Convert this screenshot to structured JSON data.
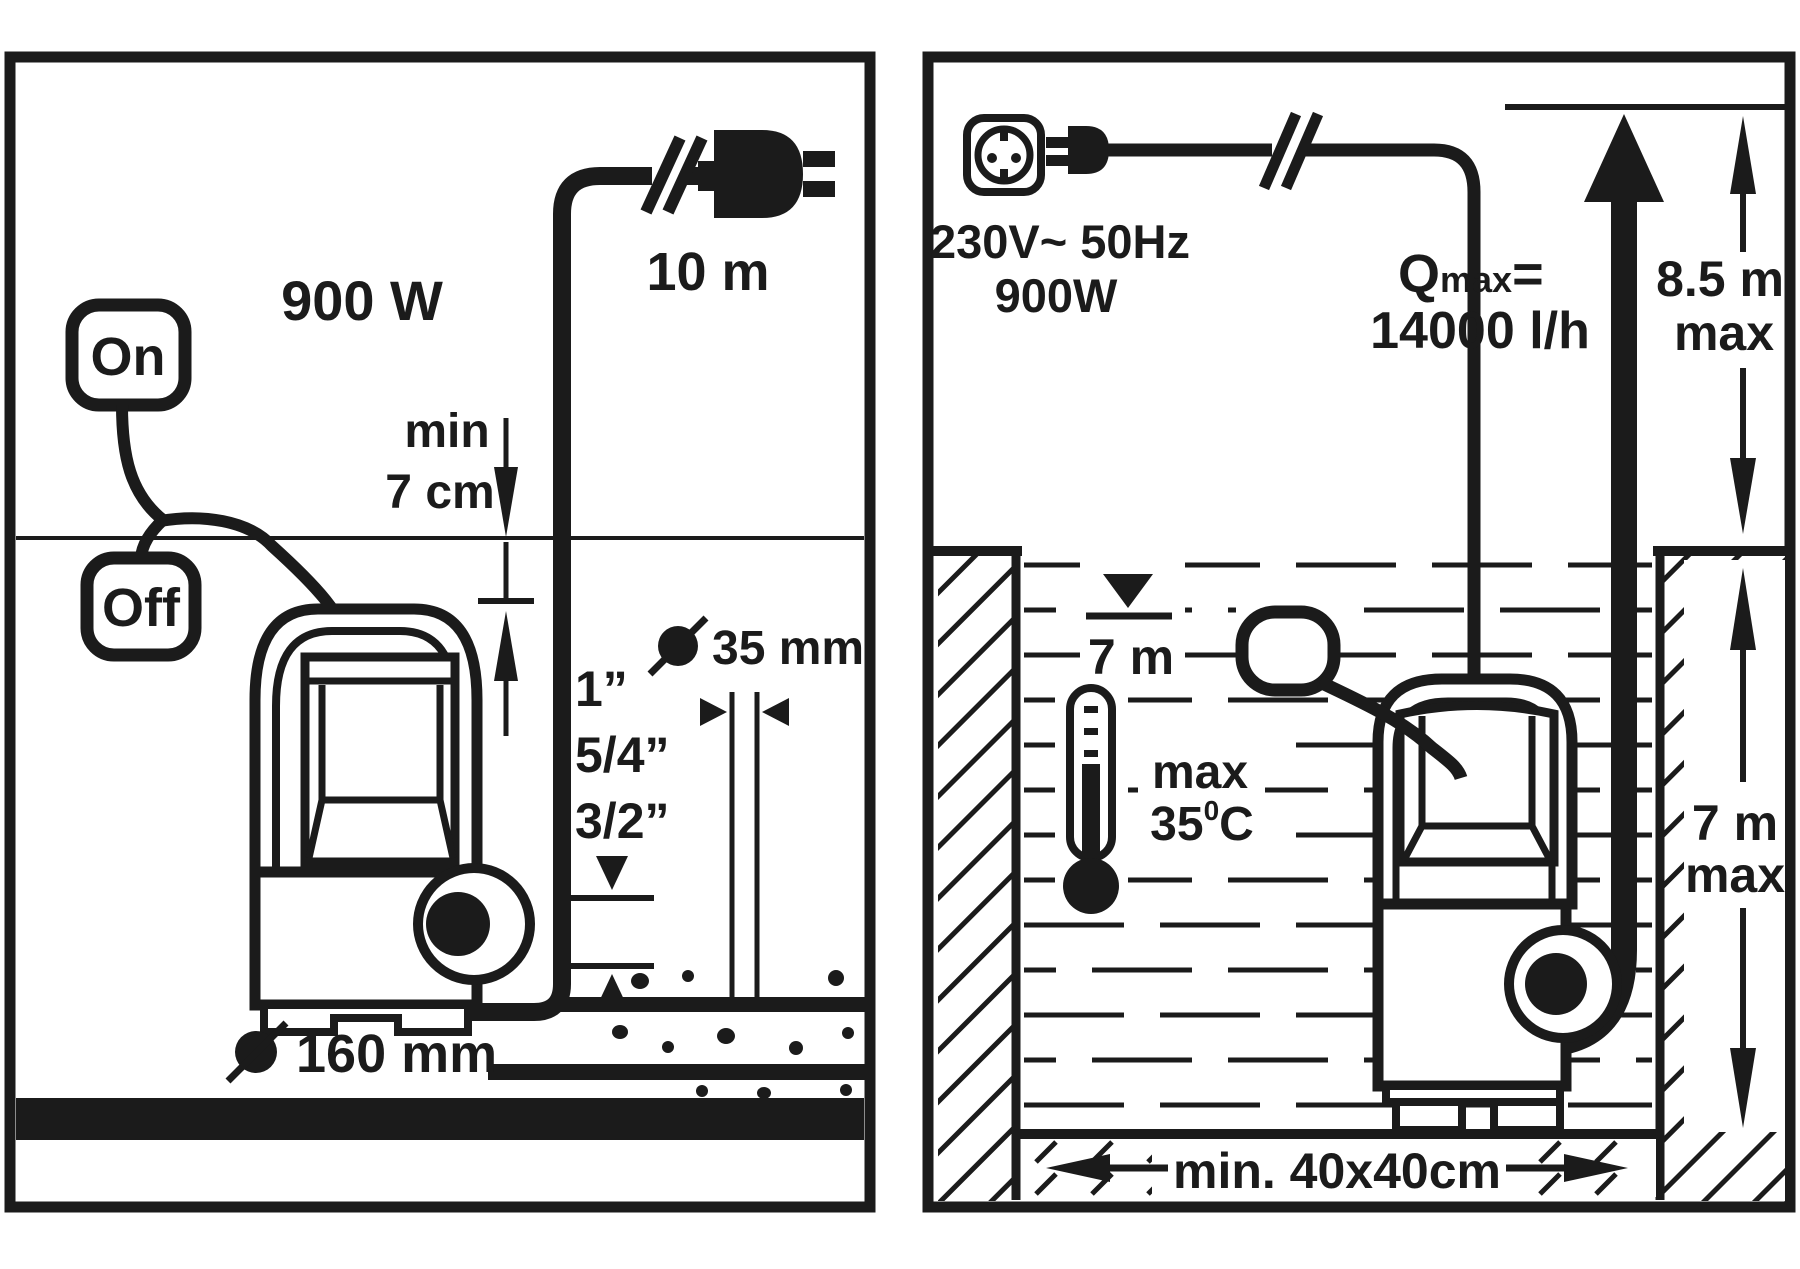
{
  "diagram": {
    "title_colors": {
      "ink": "#1b1b1b",
      "background": "#ffffff"
    },
    "left_panel": {
      "power": "900 W",
      "cable_length": "10 m",
      "switch_on": "On",
      "switch_off": "Off",
      "min_immersion_label": "min",
      "min_immersion_value": "7 cm",
      "thread_sizes": [
        "1”",
        "5/4”",
        "3/2”"
      ],
      "hose_diameter": "35 mm",
      "pit_diameter": "160 mm"
    },
    "right_panel": {
      "voltage": "230V~ 50Hz",
      "power": "900W",
      "qmax_symbol": "Q",
      "qmax_sub": "max",
      "qmax_equals": "=",
      "qmax_value": "14000 l/h",
      "max_head_value": "8.5 m",
      "max_head_suffix": "max",
      "water_level": "7 m",
      "temp_label": "max",
      "temp_value": "35",
      "temp_degree": "0",
      "temp_unit": "C",
      "max_depth_value": "7 m",
      "max_depth_suffix": "max",
      "min_pit_size": "min. 40x40cm"
    },
    "icons": {
      "left": [
        "float-switch-on",
        "float-switch-off",
        "power-plug-icon",
        "cable-break-icon",
        "pump-icon",
        "suction-pipe",
        "gravel",
        "diameter-symbol"
      ],
      "right": [
        "schuko-socket-icon",
        "power-plug-icon",
        "cable-break-icon",
        "pump-icon",
        "float-switch-icon",
        "thermometer-icon",
        "water-level-icon",
        "flow-arrow",
        "hatched-walls"
      ]
    }
  }
}
